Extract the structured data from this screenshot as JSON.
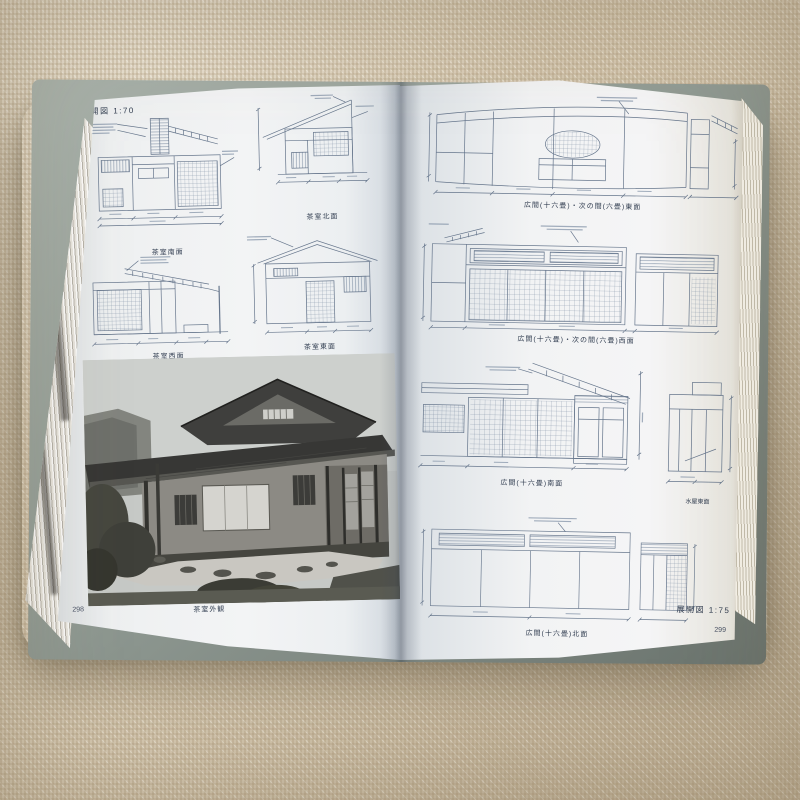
{
  "book": {
    "left_page": {
      "scale_label": "展開図 1:70",
      "figures": [
        {
          "caption": "茶室南面"
        },
        {
          "caption": "茶室北面"
        },
        {
          "caption": "茶室西面"
        },
        {
          "caption": "茶室東面"
        }
      ],
      "photo": {
        "caption": "茶室外観"
      },
      "page_number": "298"
    },
    "right_page": {
      "figures": [
        {
          "caption": "広間(十六畳)・次の間(六畳)東面"
        },
        {
          "caption": "広間(十六畳)・次の間(六畳)西面"
        },
        {
          "caption": "広間(十六畳)南面"
        },
        {
          "caption": "水屋東面"
        },
        {
          "caption": "広間(十六畳)北面"
        }
      ],
      "scale_label": "展開図 1:75",
      "page_number": "299"
    },
    "colors": {
      "fabric": "#d6c9b2",
      "page": "#eef0f2",
      "drawing_ink": "#66768c",
      "caption_ink": "#333f52",
      "cover": "#8e9a93"
    }
  }
}
